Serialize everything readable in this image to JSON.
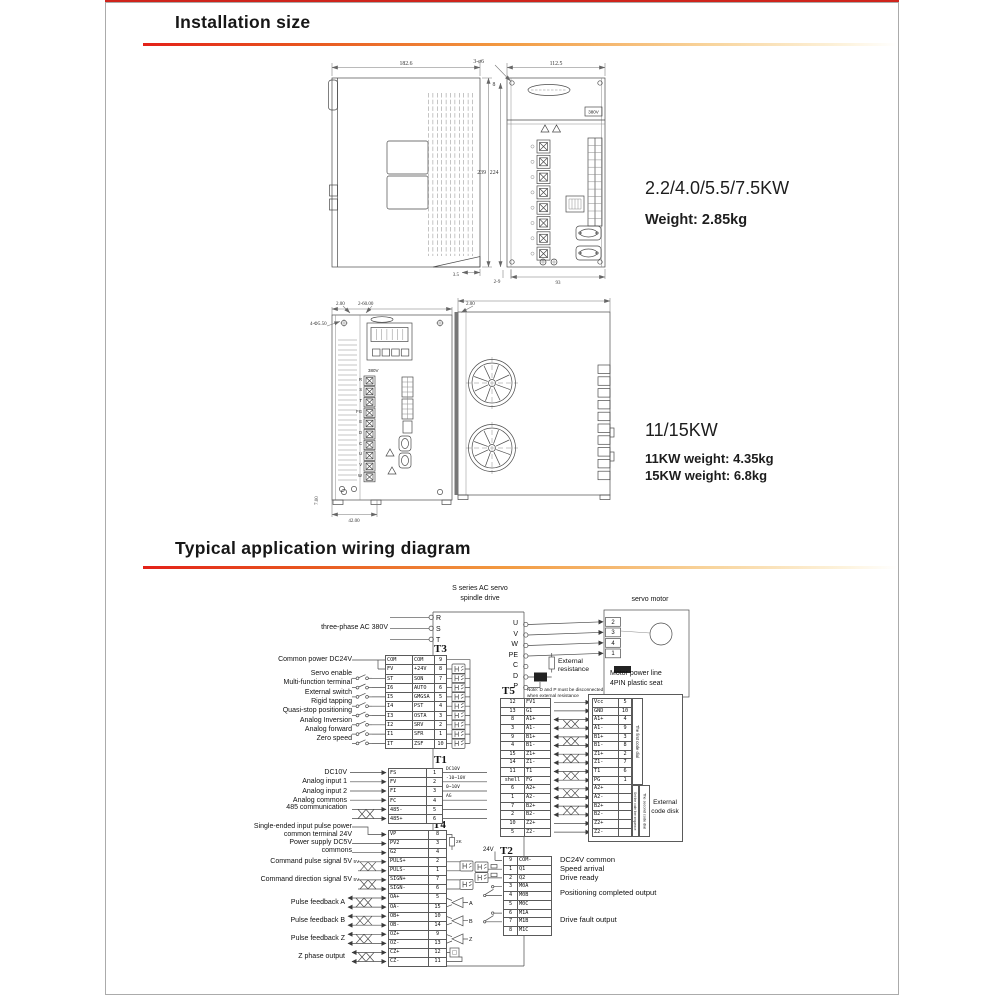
{
  "page": {
    "section1_title": "Installation size",
    "section2_title": "Typical application wiring diagram",
    "accent_red": "#cf241c"
  },
  "install": {
    "group1": {
      "models": "2.2/4.0/5.5/7.5KW",
      "weight": "Weight: 2.85kg"
    },
    "group2": {
      "models": "11/15KW",
      "weight1": "11KW weight: 4.35kg",
      "weight2": "15KW weight: 6.8kg"
    },
    "drawing1": {
      "dim_width": "182.6",
      "dim_height": "239",
      "dim_front_width": "112.5",
      "dim_front_height": "224",
      "dim_holes": "3-ø6",
      "dim_hole_offset": "8",
      "dim_bottom_left": "3.5",
      "dim_bottom_mid": "2-9",
      "dim_bottom_right": "93",
      "label_voltage": "380V"
    },
    "drawing2": {
      "dim_top_left": "2.00",
      "dim_top_mid": "2-60.00",
      "dim_holes": "4-Φ5.50",
      "dim_bottom": "42.00",
      "dim_bottom_left": "7.00",
      "dim_side_top": "2.00",
      "label_voltage": "380V",
      "terminals": [
        "R",
        "S",
        "T",
        "FG",
        "E",
        "D",
        "C",
        "U",
        "V",
        "W"
      ]
    }
  },
  "wiring": {
    "drive_title1": "S series AC servo",
    "drive_title2": "spindle drive",
    "motor_title": "servo motor",
    "input_label": "three-phase AC 380V",
    "input_terminals": [
      "R",
      "S",
      "T"
    ],
    "output_terminals": [
      "U",
      "V",
      "W",
      "PE",
      "C",
      "D",
      "P"
    ],
    "motor_pins": [
      "2",
      "3",
      "4",
      "1"
    ],
    "motor_caption1": "Motor power line",
    "motor_caption2": "4PIN plastic seat",
    "ext_resistance1": "External",
    "ext_resistance2": "resistance",
    "note1": "Note: D and P must be disconnected",
    "note2": "when external resistance",
    "t3": {
      "title": "T3",
      "power_label": "Common power DC24V",
      "switch_labels": [
        "Servo enable",
        "Multi-function terminal",
        "External switch",
        "Rigid tapping",
        "Quasi-stop positioning",
        "Analog Inversion",
        "Analog forward",
        "Zero speed"
      ],
      "rows": [
        [
          "COM",
          "COM",
          "9"
        ],
        [
          "FV",
          "+24V",
          "8"
        ],
        [
          "ST",
          "SON",
          "7"
        ],
        [
          "I6",
          "AUTO",
          "6"
        ],
        [
          "I5",
          "GMGSA",
          "5"
        ],
        [
          "I4",
          "PST",
          "4"
        ],
        [
          "I3",
          "OSTA",
          "3"
        ],
        [
          "I2",
          "SRV",
          "2"
        ],
        [
          "I1",
          "SFR",
          "1"
        ],
        [
          "IT",
          "ZSF",
          "10"
        ]
      ]
    },
    "t1": {
      "title": "T1",
      "labels": [
        "DC10V",
        "Analog input 1",
        "Analog input 2",
        "Analog commons"
      ],
      "comm_label": "485 communication",
      "notes": [
        "DC10V",
        "-10~10V",
        "0~10V",
        "AG"
      ],
      "rows": [
        [
          "FS",
          "1"
        ],
        [
          "FV",
          "2"
        ],
        [
          "FI",
          "3"
        ],
        [
          "FC",
          "4"
        ],
        [
          "485-",
          "5"
        ],
        [
          "485+",
          "6"
        ]
      ]
    },
    "t4": {
      "title": "T4",
      "labels": {
        "pulse_power1": "Single-ended input pulse power",
        "pulse_power2": "common terminal 24V",
        "dc5v1": "Power supply DC5V",
        "dc5v2": "commons",
        "cmd_pulse": "Command pulse signal 5V",
        "cmd_dir": "Command direction signal 5V",
        "fb_a": "Pulse feedback A",
        "fb_b": "Pulse feedback B",
        "fb_z": "Pulse feedback Z",
        "z_out": "Z phase output"
      },
      "small_5v_1": "5V",
      "small_5v_2": "5V",
      "res_label": "2K",
      "abz": [
        "A",
        "B",
        "Z"
      ],
      "rows": [
        [
          "VP",
          "8"
        ],
        [
          "PV2",
          "3"
        ],
        [
          "G2",
          "4"
        ],
        [
          "PULS+",
          "2"
        ],
        [
          "PULS-",
          "1"
        ],
        [
          "SIGN+",
          "7"
        ],
        [
          "SIGN-",
          "6"
        ],
        [
          "OA+",
          "5"
        ],
        [
          "OA-",
          "15"
        ],
        [
          "OB+",
          "10"
        ],
        [
          "OB-",
          "14"
        ],
        [
          "OZ+",
          "9"
        ],
        [
          "OZ-",
          "13"
        ],
        [
          "CZ+",
          "12"
        ],
        [
          "CZ-",
          "11"
        ]
      ]
    },
    "t5": {
      "title": "T5",
      "rows": [
        [
          "12",
          "FV1"
        ],
        [
          "13",
          "G1"
        ],
        [
          "8",
          "A1+"
        ],
        [
          "3",
          "A1-"
        ],
        [
          "9",
          "B1+"
        ],
        [
          "4",
          "B1-"
        ],
        [
          "15",
          "Z1+"
        ],
        [
          "14",
          "Z1-"
        ],
        [
          "11",
          "T1"
        ],
        [
          "shell",
          "FG"
        ],
        [
          "6",
          "A2+"
        ],
        [
          "1",
          "A2-"
        ],
        [
          "7",
          "B2+"
        ],
        [
          "2",
          "B2-"
        ],
        [
          "10",
          "Z2+"
        ],
        [
          "5",
          "Z2-"
        ]
      ]
    },
    "encoder": {
      "rows": [
        [
          "Vcc",
          "5"
        ],
        [
          "GND",
          "10"
        ],
        [
          "A1+",
          "4"
        ],
        [
          "A1-",
          "9"
        ],
        [
          "B1+",
          "3"
        ],
        [
          "B1-",
          "8"
        ],
        [
          "Z1+",
          "2"
        ],
        [
          "Z1-",
          "7"
        ],
        [
          "T1",
          "6"
        ],
        [
          "PG",
          "1"
        ],
        [
          "A2+",
          ""
        ],
        [
          "A2-",
          ""
        ],
        [
          "B2+",
          ""
        ],
        [
          "B2-",
          ""
        ],
        [
          "Z2+",
          ""
        ],
        [
          "Z2-",
          ""
        ]
      ],
      "dial1": "The first code dial",
      "seq": "Set the code line sequence",
      "dial2": "The second code dial",
      "caption1": "External",
      "caption2": "code disk"
    },
    "t2": {
      "title": "T2",
      "v24": "24V",
      "rows": [
        [
          "9",
          "COM-"
        ],
        [
          "1",
          "Q1"
        ],
        [
          "2",
          "Q2"
        ],
        [
          "3",
          "M0A"
        ],
        [
          "4",
          "M0B"
        ],
        [
          "5",
          "M0C"
        ],
        [
          "6",
          "M1A"
        ],
        [
          "7",
          "M1B"
        ],
        [
          "8",
          "M1C"
        ]
      ],
      "labels": [
        "DC24V common",
        "Speed arrival",
        "Drive ready",
        "Positioning completed output",
        "Drive fault output"
      ]
    }
  }
}
